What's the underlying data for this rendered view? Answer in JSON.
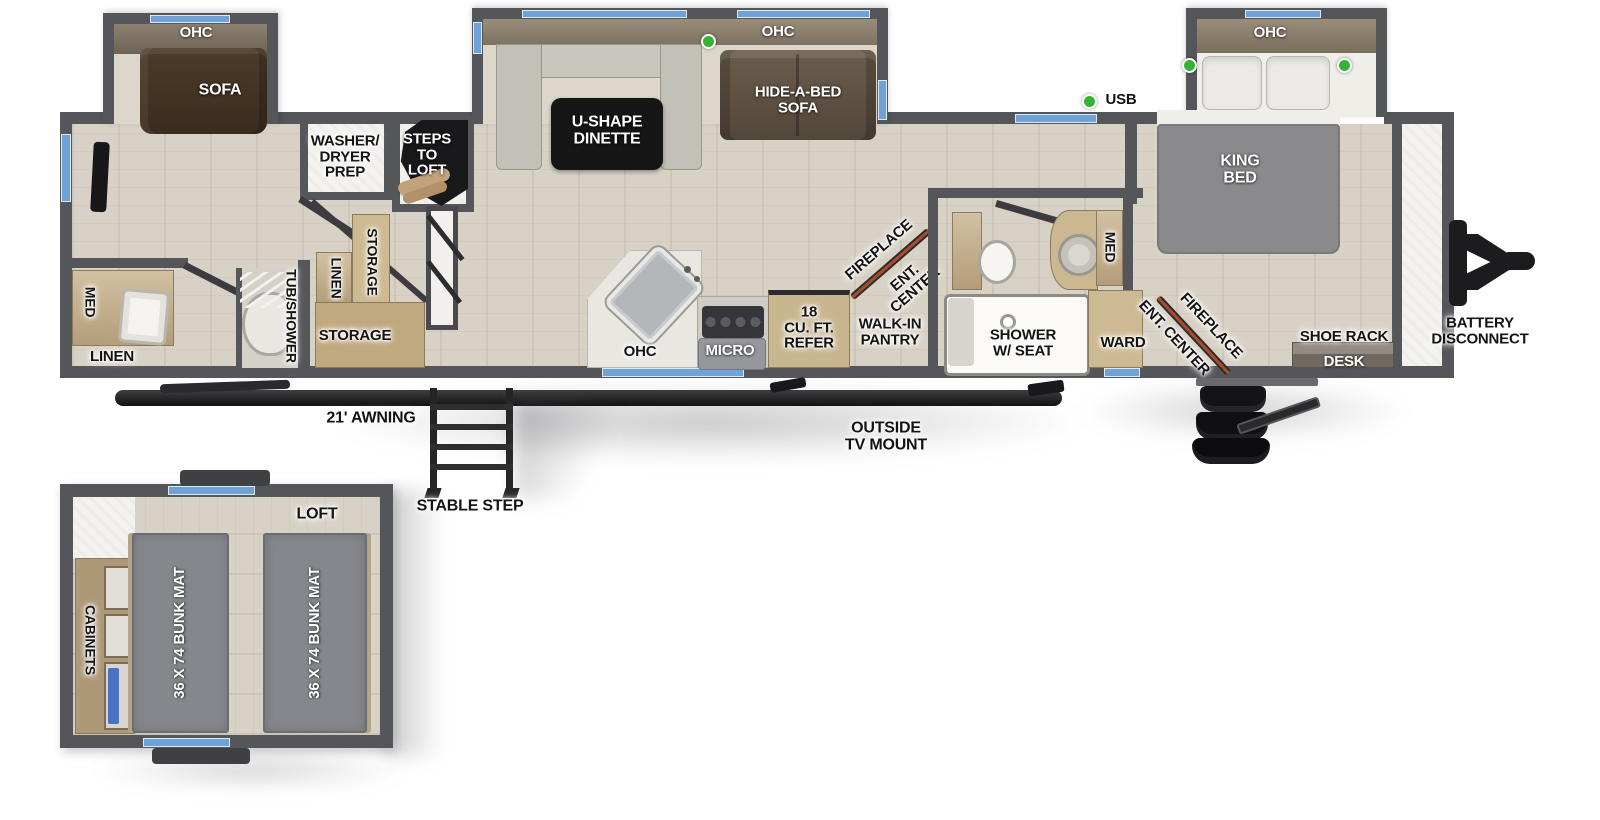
{
  "colors": {
    "wall": "#55565a",
    "floor_wood": "#d8d1c5",
    "window_blue": "#6fa3d8",
    "led_green": "#35b335",
    "fireplace_stripe": "#a84a2c",
    "cabinet_tan": "#c3ab84",
    "bed_gray": "#8a8a8c",
    "sofa_brown": "#46362a",
    "step_black": "#19191b"
  },
  "labels": {
    "rear_slide_ohc": "OHC",
    "sofa": "SOFA",
    "dinette_ohc": "OHC",
    "dinette_table": "U-SHAPE\nDINETTE",
    "hide_a_bed": "HIDE-A-BED\nSOFA",
    "king_ohc": "OHC",
    "usb": "USB",
    "king_bed": "KING\nBED",
    "washer_dryer": "WASHER/\nDRYER\nPREP",
    "steps_to_loft": "STEPS\nTO\nLOFT",
    "linen_v": "LINEN",
    "storage_v": "STORAGE",
    "storage": "STORAGE",
    "bath_med": "MED",
    "bath_linen": "LINEN",
    "tub_shower": "TUB/SHOWER",
    "kitchen_ohc": "OHC",
    "micro": "MICRO",
    "refer": "18\nCU. FT.\nREFER",
    "fireplace_mid": "FIREPLACE",
    "ent_center_mid": "ENT.\nCENTER",
    "pantry": "WALK-IN\nPANTRY",
    "shower_seat": "SHOWER\nW/ SEAT",
    "bath2_med": "MED",
    "ward": "WARD",
    "ent_center_bed": "ENT. CENTER",
    "fireplace_bed": "FIREPLACE",
    "shoe_rack": "SHOE RACK",
    "desk": "DESK",
    "battery": "BATTERY\nDISCONNECT",
    "awning": "21' AWNING",
    "stable_step": "STABLE STEP",
    "outside_tv": "OUTSIDE\nTV MOUNT",
    "loft": "LOFT",
    "bunk1": "36 X 74 BUNK MAT",
    "bunk2": "36 X 74 BUNK MAT",
    "cabinets": "CABINETS"
  }
}
